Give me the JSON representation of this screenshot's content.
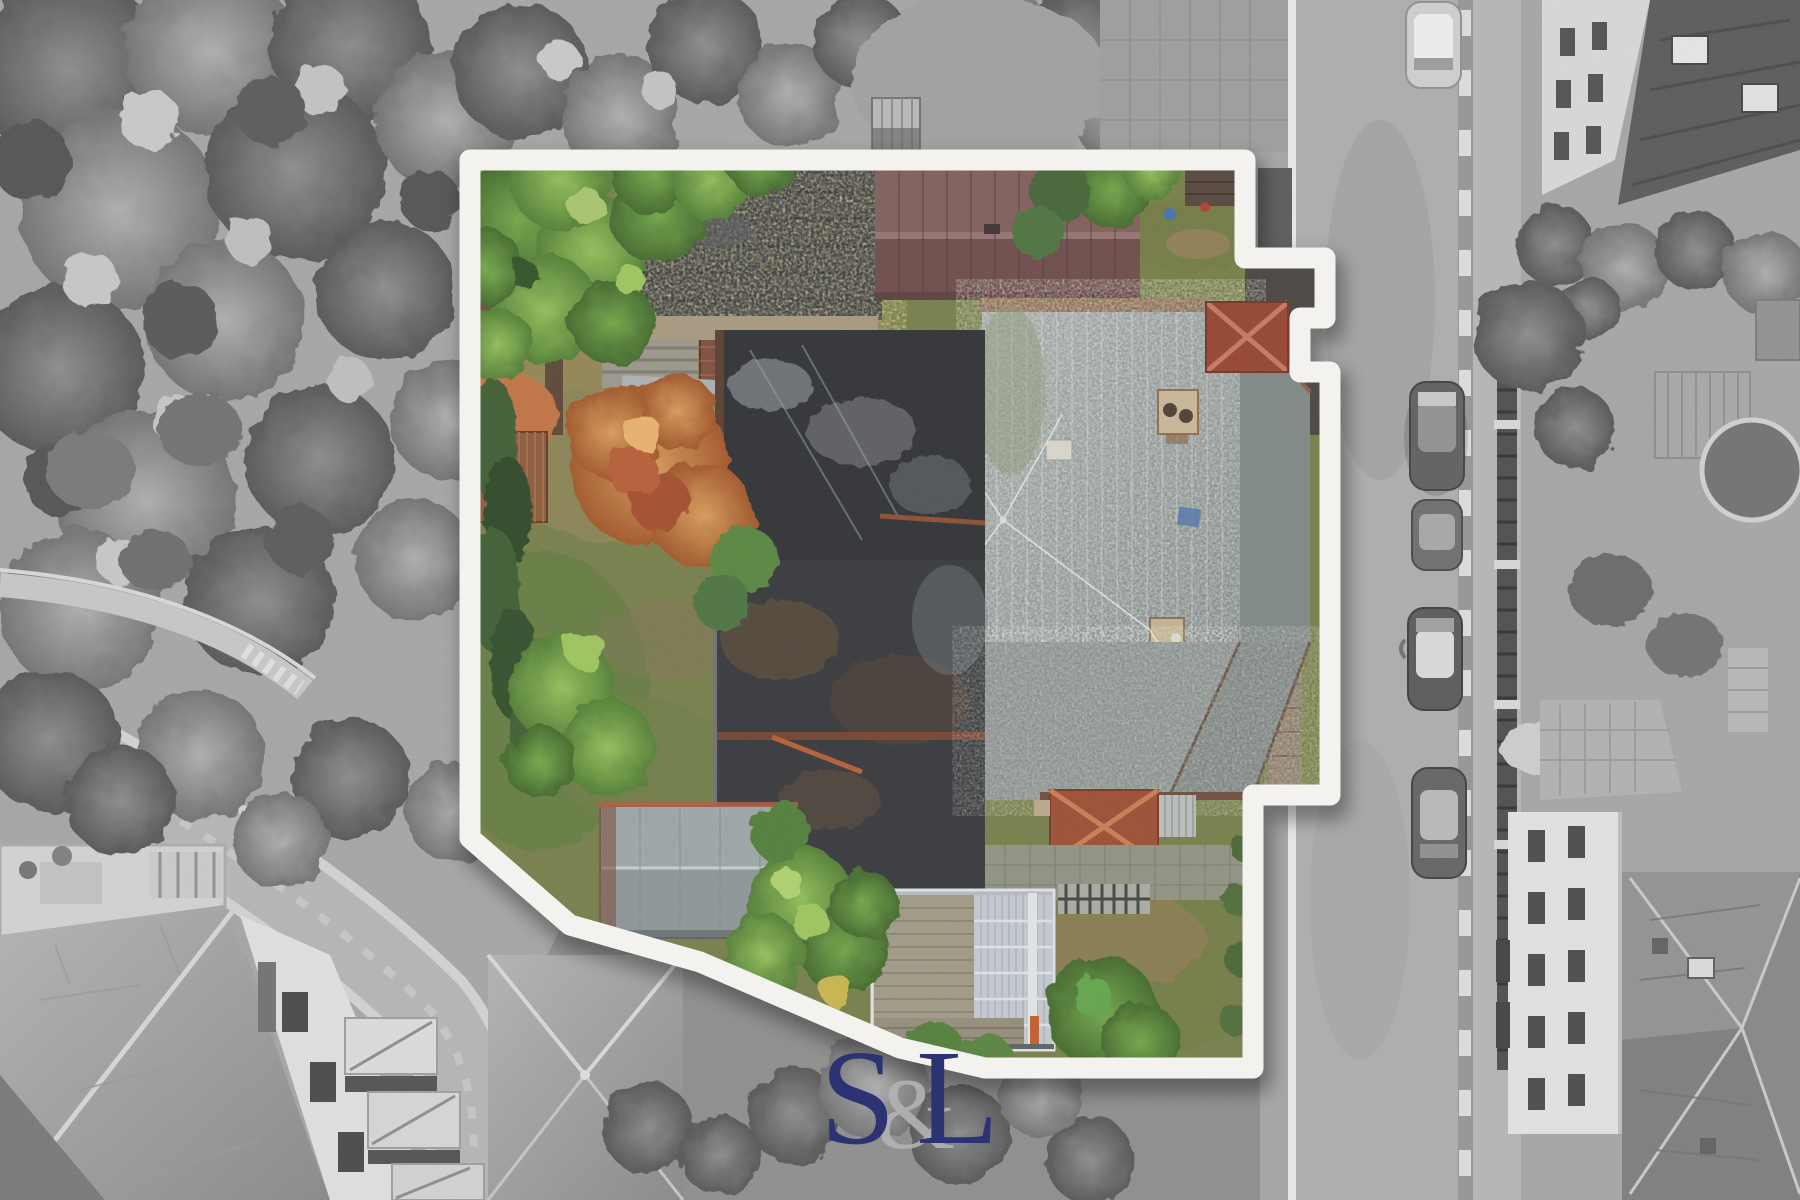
{
  "meta": {
    "kind": "aerial-drone-photograph",
    "width": 1800,
    "height": 1200,
    "description": "Overhead drone photo of a corner property. The lot interior is shown in full colour inside a thick white boundary outline with soft shadow; all surroundings (streets, roofs, trees, parked cars) are desaturated greyscale. A serif S&L watermark sits bottom-centre."
  },
  "watermark": {
    "s": "S",
    "amp": "&",
    "l": "L",
    "letter_color": "#2b3372",
    "amp_color": "#b4b4b4"
  },
  "boundary": {
    "path": "M470,160 L1245,160 L1245,258 L1325,258 L1325,318 L1300,318 L1300,372 L1330,372 L1330,795 L1253,795 L1253,1068 L985,1068 L900,1048 L700,962 L570,925 L470,838 Z",
    "color": "#f8f7f3",
    "stroke_width": "21",
    "shadow_color": "#000000"
  },
  "palette": {
    "lawn_green": "#747c46",
    "autumn_tree": "#c07a3e",
    "barn_roof_maroon": "#6a4846",
    "main_roof_grey": "#8f9794",
    "red_hip_cap": "#93402c",
    "tar_roof": "#3b3e42",
    "asphalt_grey": "#a4a4a4"
  }
}
